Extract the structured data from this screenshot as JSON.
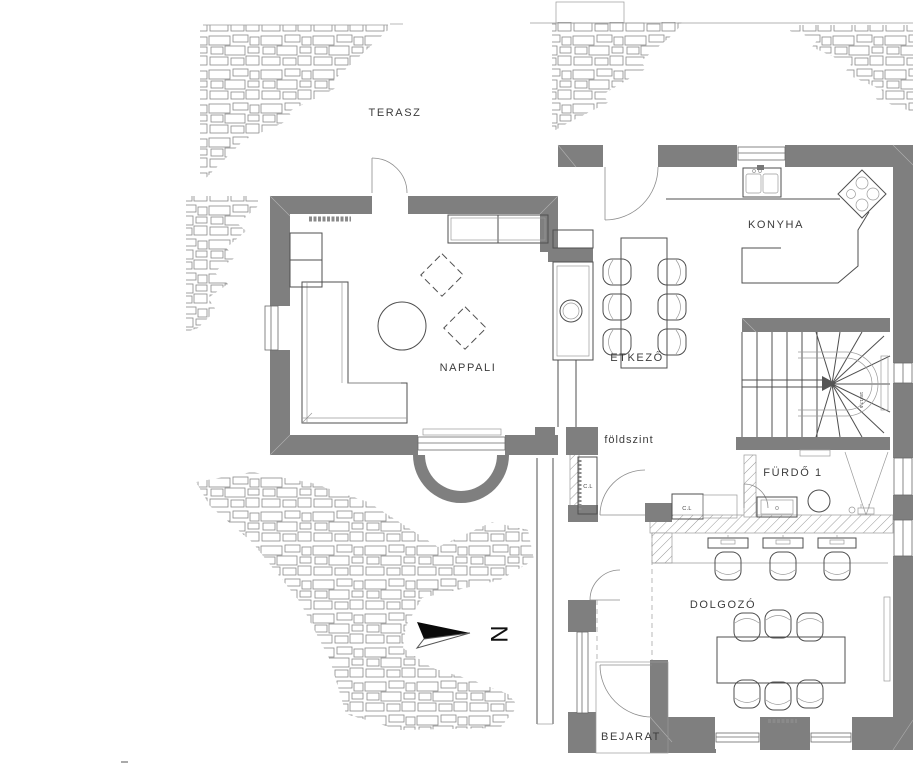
{
  "plan": {
    "floor_label": "földszint",
    "rooms": [
      {
        "id": "terasz",
        "label": "TERASZ"
      },
      {
        "id": "nappali",
        "label": "NAPPALI"
      },
      {
        "id": "konyha",
        "label": "KONYHA"
      },
      {
        "id": "etkezo",
        "label": "ETKEZŐ"
      },
      {
        "id": "furdo1",
        "label": "FÜRDŐ 1"
      },
      {
        "id": "dolgozo",
        "label": "DOLGOZÓ"
      },
      {
        "id": "bejarat",
        "label": "BEJARAT"
      }
    ],
    "annotations": {
      "closet_a": "C.L",
      "closet_b": "C.L",
      "stair_note": "18×17,5"
    },
    "north": {
      "label": "N"
    },
    "colors": {
      "wall": "#7f7f7f",
      "line": "#4f4f4f",
      "light_line": "#9a9a9a",
      "text": "#3c3c3c",
      "background": "#ffffff",
      "arrow": "#0a0a0a"
    },
    "fixtures": [
      "stone-cladding",
      "sofa",
      "coffee-table",
      "armchair",
      "sideboard",
      "fireplace",
      "dining-table",
      "dining-chair",
      "kitchen-counter",
      "kitchen-sink",
      "cooktop",
      "winder-stairs",
      "bathroom-vanity",
      "toilet",
      "shower",
      "desk",
      "desk-chair",
      "meeting-table",
      "meeting-chair",
      "radiator",
      "entry-porch",
      "entry-steps"
    ]
  }
}
